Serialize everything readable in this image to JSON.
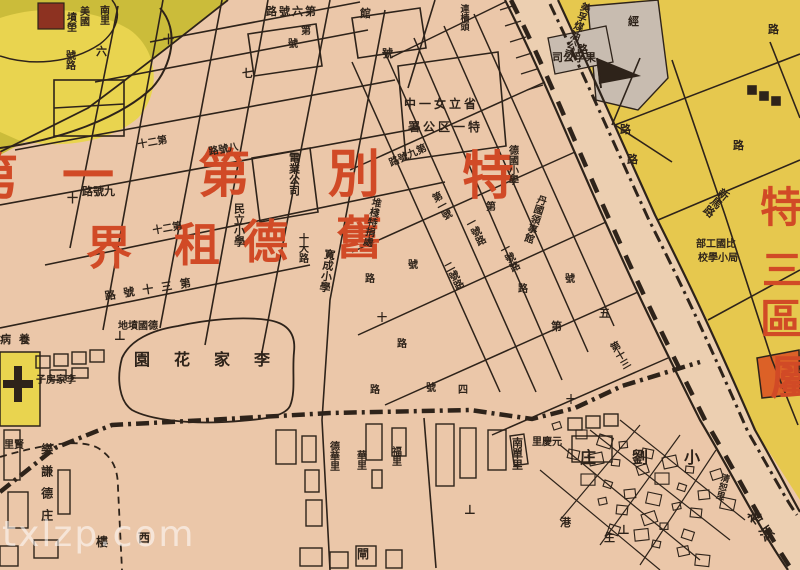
{
  "meta": {
    "watermark": "txlzp.com"
  },
  "map": {
    "colors": {
      "paper": "#ebc7a9",
      "river_band": "#eccfb1",
      "yellow_district": "#e6c84e",
      "olive_field": "#cbbc3a",
      "bright_yellow": "#e9d44f",
      "gray_block": "#c8bcb0",
      "red_text": "#d14a26",
      "orange_building": "#dc6127",
      "maroon_block": "#8d3221",
      "ink": "#2e231a"
    },
    "district_titles": {
      "main_row1": "特別第一",
      "main_row2": "舊德租界",
      "east_column": "特三區屬"
    },
    "labels": [
      {
        "name": "district-char",
        "text": "特",
        "x": 462,
        "y": 150,
        "s": 52,
        "c": "r"
      },
      {
        "name": "district-char",
        "text": "別",
        "x": 328,
        "y": 148,
        "s": 52,
        "c": "r"
      },
      {
        "name": "district-char",
        "text": "第",
        "x": 198,
        "y": 148,
        "s": 52,
        "c": "r"
      },
      {
        "name": "district-char",
        "text": "一",
        "x": 62,
        "y": 150,
        "s": 52,
        "c": "r"
      },
      {
        "name": "district-char",
        "text": "舊",
        "x": 336,
        "y": 214,
        "s": 46,
        "c": "r"
      },
      {
        "name": "district-char",
        "text": "德",
        "x": 242,
        "y": 218,
        "s": 46,
        "c": "r"
      },
      {
        "name": "district-char",
        "text": "租",
        "x": 174,
        "y": 221,
        "s": 46,
        "c": "r"
      },
      {
        "name": "district-char",
        "text": "界",
        "x": 86,
        "y": 224,
        "s": 46,
        "c": "r"
      },
      {
        "name": "district-char-partial",
        "text": "第",
        "x": -34,
        "y": 152,
        "s": 52,
        "c": "r"
      },
      {
        "name": "district-char",
        "text": "特",
        "x": 760,
        "y": 186,
        "s": 42,
        "c": "r"
      },
      {
        "name": "district-char",
        "text": "三",
        "x": 762,
        "y": 250,
        "s": 40,
        "c": "r"
      },
      {
        "name": "district-char",
        "text": "區",
        "x": 760,
        "y": 298,
        "s": 42,
        "c": "r"
      },
      {
        "name": "district-char-partial",
        "text": "屬",
        "x": 770,
        "y": 354,
        "s": 46,
        "c": "r"
      },
      {
        "name": "place-label",
        "text": "美國",
        "x": 77,
        "y": 6,
        "s": 10,
        "o": "v"
      },
      {
        "name": "place-label",
        "text": "墳塋",
        "x": 64,
        "y": 12,
        "s": 10,
        "o": "v"
      },
      {
        "name": "place-label",
        "text": "南里",
        "x": 97,
        "y": 5,
        "s": 10,
        "o": "v"
      },
      {
        "name": "street-label",
        "text": "六",
        "x": 96,
        "y": 46,
        "s": 11
      },
      {
        "name": "street-label",
        "text": "十",
        "x": 163,
        "y": 34,
        "s": 11
      },
      {
        "name": "street-label",
        "text": "號路",
        "x": 63,
        "y": 50,
        "s": 10,
        "o": "v"
      },
      {
        "name": "street-label",
        "text": "第六號路",
        "x": 266,
        "y": 6,
        "s": 11,
        "o": "hr",
        "ls": 2
      },
      {
        "name": "street-label",
        "text": "七",
        "x": 242,
        "y": 68,
        "s": 11
      },
      {
        "name": "street-label",
        "text": "號",
        "x": 288,
        "y": 40,
        "s": 10
      },
      {
        "name": "street-label",
        "text": "第",
        "x": 301,
        "y": 27,
        "s": 10
      },
      {
        "name": "street-label",
        "text": "號",
        "x": 382,
        "y": 48,
        "s": 11
      },
      {
        "name": "place-label",
        "text": "館",
        "x": 360,
        "y": 8,
        "s": 11
      },
      {
        "name": "place-label",
        "text": "連檣頭",
        "x": 458,
        "y": 4,
        "s": 9,
        "o": "v"
      },
      {
        "name": "place-label",
        "text": "省立女一中",
        "x": 404,
        "y": 98,
        "s": 12,
        "o": "hr",
        "ls": 3
      },
      {
        "name": "place-label",
        "text": "特一区公署",
        "x": 408,
        "y": 121,
        "s": 12,
        "o": "hr",
        "ls": 3
      },
      {
        "name": "place-label",
        "text": "德國小學",
        "x": 506,
        "y": 145,
        "s": 10,
        "o": "v"
      },
      {
        "name": "place-label",
        "text": "丹國領事館",
        "x": 536,
        "y": 193,
        "s": 10,
        "o": "v",
        "rot": 18
      },
      {
        "name": "place-label",
        "text": "電業公司",
        "x": 288,
        "y": 152,
        "s": 11,
        "o": "v"
      },
      {
        "name": "place-label",
        "text": "民立小學",
        "x": 233,
        "y": 203,
        "s": 11,
        "o": "v"
      },
      {
        "name": "place-label",
        "text": "寬成小學",
        "x": 324,
        "y": 248,
        "s": 11,
        "o": "v",
        "rot": 8
      },
      {
        "name": "street-label",
        "text": "十大路",
        "x": 296,
        "y": 233,
        "s": 10,
        "o": "v"
      },
      {
        "name": "place-label",
        "text": "堆棧特捐處",
        "x": 370,
        "y": 196,
        "s": 10,
        "o": "v",
        "rot": 12
      },
      {
        "name": "street-label",
        "text": "第九號路",
        "x": 388,
        "y": 160,
        "s": 10,
        "o": "hr",
        "rot": -24
      },
      {
        "name": "street-label",
        "text": "九號路",
        "x": 82,
        "y": 186,
        "s": 11,
        "o": "hr"
      },
      {
        "name": "street-label",
        "text": "十",
        "x": 67,
        "y": 193,
        "s": 11
      },
      {
        "name": "street-label",
        "text": "八號路",
        "x": 208,
        "y": 148,
        "s": 10,
        "o": "hr",
        "rot": -10
      },
      {
        "name": "street-label",
        "text": "第二十",
        "x": 137,
        "y": 141,
        "s": 10,
        "o": "hr",
        "rot": -10
      },
      {
        "name": "street-label",
        "text": "第二十",
        "x": 152,
        "y": 227,
        "s": 10,
        "o": "hr",
        "rot": -10
      },
      {
        "name": "street-label",
        "text": "第三十號路",
        "x": 104,
        "y": 291,
        "s": 11,
        "o": "hr",
        "rot": -9,
        "ls": 8
      },
      {
        "name": "place-label",
        "text": "德國墳地",
        "x": 118,
        "y": 322,
        "s": 10,
        "o": "hr"
      },
      {
        "name": "place-label",
        "text": "李家花園",
        "x": 134,
        "y": 352,
        "s": 16,
        "o": "hr",
        "ls": 24
      },
      {
        "name": "place-label",
        "text": "李家房子",
        "x": 36,
        "y": 376,
        "s": 10,
        "o": "hr"
      },
      {
        "name": "place-label",
        "text": "養病",
        "x": 0,
        "y": 334,
        "s": 11,
        "o": "hr",
        "ls": 8
      },
      {
        "name": "place-label",
        "text": "賢里",
        "x": 4,
        "y": 441,
        "s": 10,
        "o": "hr"
      },
      {
        "name": "place-label",
        "text": "樂謙德庄",
        "x": 40,
        "y": 443,
        "s": 12,
        "o": "v",
        "ls": 10
      },
      {
        "name": "place-label",
        "text": "西",
        "x": 138,
        "y": 532,
        "s": 12
      },
      {
        "name": "place-label",
        "text": "樓",
        "x": 96,
        "y": 536,
        "s": 12
      },
      {
        "name": "place-label",
        "text": "德華里",
        "x": 327,
        "y": 441,
        "s": 10,
        "o": "v"
      },
      {
        "name": "place-label",
        "text": "華里",
        "x": 354,
        "y": 450,
        "s": 10,
        "o": "v"
      },
      {
        "name": "place-label",
        "text": "福里",
        "x": 389,
        "y": 446,
        "s": 10,
        "o": "v"
      },
      {
        "name": "place-label",
        "text": "南單里",
        "x": 511,
        "y": 437,
        "s": 11,
        "o": "v"
      },
      {
        "name": "place-label",
        "text": "元慶里",
        "x": 532,
        "y": 438,
        "s": 10,
        "o": "hr"
      },
      {
        "name": "place-label",
        "text": "小劉庄",
        "x": 580,
        "y": 450,
        "s": 16,
        "o": "hr",
        "ls": 36
      },
      {
        "name": "place-label",
        "text": "清恕里",
        "x": 720,
        "y": 472,
        "s": 9,
        "o": "v",
        "rot": 15
      },
      {
        "name": "place-label",
        "text": "裕源",
        "x": 744,
        "y": 516,
        "s": 14,
        "o": "v",
        "rot": -35,
        "ls": 6
      },
      {
        "name": "place-label",
        "text": "港",
        "x": 560,
        "y": 517,
        "s": 11
      },
      {
        "name": "place-label",
        "text": "生",
        "x": 604,
        "y": 532,
        "s": 11
      },
      {
        "name": "place-label",
        "text": "閘",
        "x": 357,
        "y": 548,
        "s": 12
      },
      {
        "name": "street-label",
        "text": "第一號",
        "x": 428,
        "y": 196,
        "s": 10,
        "o": "v",
        "rot": -28
      },
      {
        "name": "street-label",
        "text": "一號路",
        "x": 462,
        "y": 222,
        "s": 10,
        "o": "v",
        "rot": -28
      },
      {
        "name": "street-label",
        "text": "二號路",
        "x": 440,
        "y": 266,
        "s": 10,
        "o": "v",
        "rot": -28
      },
      {
        "name": "street-label",
        "text": "號",
        "x": 408,
        "y": 261,
        "s": 10
      },
      {
        "name": "street-label",
        "text": "路",
        "x": 365,
        "y": 275,
        "s": 10
      },
      {
        "name": "street-label",
        "text": "十",
        "x": 377,
        "y": 314,
        "s": 10
      },
      {
        "name": "street-label",
        "text": "路",
        "x": 397,
        "y": 340,
        "s": 10
      },
      {
        "name": "street-label",
        "text": "第",
        "x": 486,
        "y": 203,
        "s": 10
      },
      {
        "name": "street-label",
        "text": "一號路",
        "x": 496,
        "y": 248,
        "s": 10,
        "o": "v",
        "rot": -28
      },
      {
        "name": "street-label",
        "text": "路",
        "x": 518,
        "y": 285,
        "s": 10
      },
      {
        "name": "street-label",
        "text": "五",
        "x": 599,
        "y": 308,
        "s": 11
      },
      {
        "name": "street-label",
        "text": "第",
        "x": 551,
        "y": 321,
        "s": 11
      },
      {
        "name": "street-label",
        "text": "號",
        "x": 565,
        "y": 275,
        "s": 10
      },
      {
        "name": "street-label",
        "text": "第十三",
        "x": 606,
        "y": 346,
        "s": 10,
        "o": "v",
        "rot": -30
      },
      {
        "name": "street-label",
        "text": "路",
        "x": 370,
        "y": 386,
        "s": 10
      },
      {
        "name": "street-label",
        "text": "號",
        "x": 426,
        "y": 384,
        "s": 10
      },
      {
        "name": "street-label",
        "text": "四",
        "x": 458,
        "y": 386,
        "s": 10
      },
      {
        "name": "street-label",
        "text": "十",
        "x": 566,
        "y": 396,
        "s": 10
      },
      {
        "name": "street-label",
        "text": "新馬路",
        "x": 722,
        "y": 186,
        "s": 11,
        "o": "v",
        "rot": 40
      },
      {
        "name": "street-label",
        "text": "經",
        "x": 628,
        "y": 16,
        "s": 11
      },
      {
        "name": "street-label",
        "text": "路",
        "x": 577,
        "y": 44,
        "s": 11
      },
      {
        "name": "street-label",
        "text": "路",
        "x": 620,
        "y": 124,
        "s": 11
      },
      {
        "name": "street-label",
        "text": "路",
        "x": 733,
        "y": 140,
        "s": 11
      },
      {
        "name": "street-label",
        "text": "路",
        "x": 627,
        "y": 154,
        "s": 11
      },
      {
        "name": "street-label",
        "text": "路",
        "x": 768,
        "y": 24,
        "s": 11
      },
      {
        "name": "place-label",
        "text": "美孚煤油公司",
        "x": 580,
        "y": 0,
        "s": 10,
        "o": "v",
        "rot": 20
      },
      {
        "name": "place-label",
        "text": "果孚公司",
        "x": 552,
        "y": 52,
        "s": 11,
        "o": "hr"
      },
      {
        "name": "place-label",
        "text": "比國工部",
        "x": 696,
        "y": 240,
        "s": 10,
        "o": "hr"
      },
      {
        "name": "place-label",
        "text": "局小學校",
        "x": 698,
        "y": 254,
        "s": 10,
        "o": "hr"
      },
      {
        "name": "grave-symbol",
        "text": "⊥",
        "x": 114,
        "y": 330,
        "s": 13
      },
      {
        "name": "grave-symbol",
        "text": "⊥",
        "x": 464,
        "y": 504,
        "s": 13
      },
      {
        "name": "grave-symbol",
        "text": "⊥",
        "x": 618,
        "y": 524,
        "s": 13
      }
    ]
  }
}
